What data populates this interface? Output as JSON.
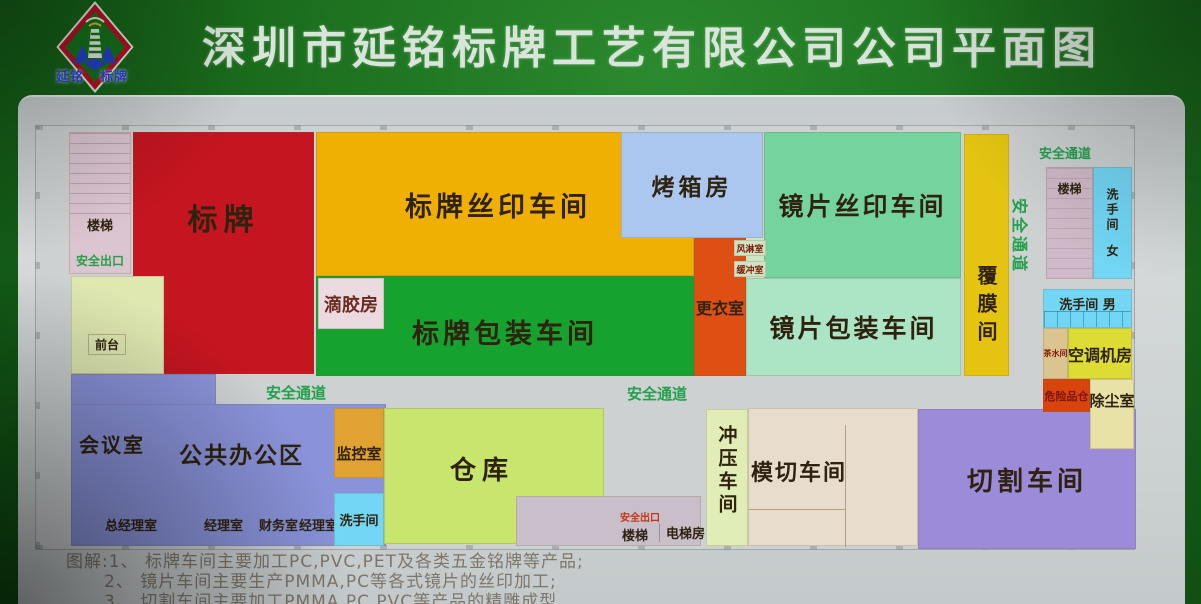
{
  "header": {
    "title": "深圳市延铭标牌工艺有限公司公司平面图",
    "logo_left": "延铭",
    "logo_right": "标牌"
  },
  "colors": {
    "bg_green": "#1a6b1c",
    "floor": "#cdd1d2",
    "stairs_left_pink": "#dbc5d1",
    "front_desk_cream": "#e0e8b2",
    "sign_red": "#c41520",
    "silkscreen_orange": "#f0b003",
    "oven_blue": "#abc7ef",
    "lens_silkscreen_green": "#75d49e",
    "film_yellow": "#e5c411",
    "stairs_right_pink": "#d0b9c8",
    "toilet_blue": "#72d6f4",
    "tea_tan": "#dbc48f",
    "ac_yellow": "#dcdc35",
    "hazmat_red": "#d8440e",
    "dust_pale": "#e9e2a6",
    "changing_orange": "#dd4f13",
    "smallbox_pale": "#cfe4c4",
    "packaging_green": "#16a22e",
    "glue_pink": "#ecdae1",
    "lens_packaging_green": "#abe5c6",
    "office_purple": "#8a93da",
    "monitor_orange": "#e0a232",
    "warehouse_green": "#c8e56e",
    "exitbox_gray": "#c9bfcb",
    "punch_pale": "#e0edb6",
    "diecut_beige": "#e8ddcd",
    "cutting_purple": "#9b8bd8",
    "corridor_green_text": "#23a04a",
    "exit_red_text": "#c53413",
    "dark_red_text": "#7c1603",
    "label_dark": "#2f2310"
  },
  "rooms": {
    "stairs_left": "楼梯",
    "exit_left": "安全出口",
    "front_desk": "前台",
    "sign": "标牌",
    "sign_silkscreen": "标牌丝印车间",
    "oven": "烤箱房",
    "lens_silkscreen": "镜片丝印车间",
    "film": "覆膜间",
    "corridor_vertical": "安全通道",
    "corridor_top_right": "安全通道",
    "stairs_right": "楼梯",
    "toilet_women": "洗手间",
    "women": "女",
    "toilet_men": "洗手间 男",
    "tea": "茶水间",
    "ac": "空调机房",
    "hazmat": "危险品仓",
    "dust": "除尘室",
    "changing": "更衣室",
    "air_shower": "风淋室",
    "buffer": "缓冲室",
    "sign_packaging": "标牌包装车间",
    "glue": "滴胶房",
    "lens_packaging": "镜片包装车间",
    "corridor_mid_a": "安全通道",
    "corridor_mid_b": "安全通道",
    "meeting": "会议室",
    "open_office": "公共办公区",
    "monitor": "监控室",
    "gm_office": "总经理室",
    "manager1": "经理室",
    "finance": "财务室",
    "manager2": "经理室",
    "toilet_small": "洗手间",
    "warehouse": "仓库",
    "exit_mid": "安全出口",
    "stairs_mid": "楼梯",
    "elevator": "电梯房",
    "punch": "冲压车间",
    "die_cut": "模切车间",
    "cutting": "切割车间"
  },
  "legend": {
    "l1": "图解:1、 标牌车间主要加工PC,PVC,PET及各类五金铭牌等产品;",
    "l2": "2、 镜片车间主要生产PMMA,PC等各式镜片的丝印加工;",
    "l3": "3、 切割车间主要加工PMMA,PC,PVC等产品的精雕成型"
  }
}
